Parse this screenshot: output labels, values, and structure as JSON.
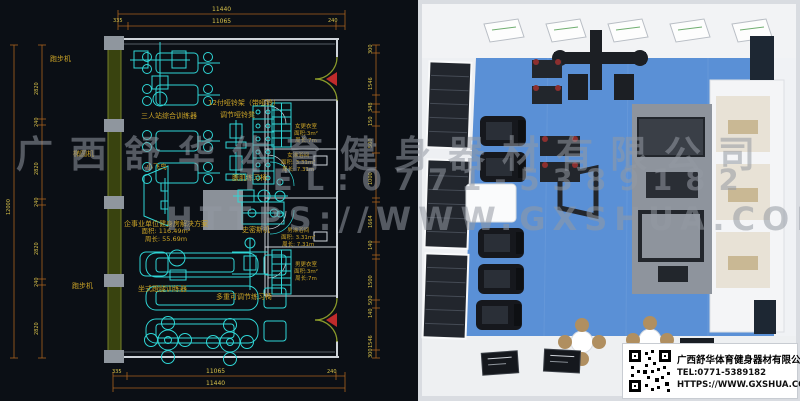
{
  "watermark": {
    "line1": "广西舒华体育健身器材有限公司",
    "line2": "TEL:0771-5389182",
    "line3": "HTTPS://WWW.GXSHUA.COM"
  },
  "info_card": {
    "company": "广西舒华体育健身器材有限公司",
    "tel": "TEL:0771-5389182",
    "website": "HTTPS://WWW.GXSHUA.COM",
    "qr_icon": "qr-code"
  },
  "cad": {
    "equipment_labels": [
      {
        "text": "跑步机"
      },
      {
        "text": "椭圆机"
      },
      {
        "text": "跑步机"
      },
      {
        "text": "三人站综合训练器"
      },
      {
        "text": "12付哑铃架（带哑铃）"
      },
      {
        "text": "调节哑铃凳"
      },
      {
        "text": "小飞鸟"
      },
      {
        "text": "坐式蹬腿训练器"
      },
      {
        "text": "腹肌练习椅"
      },
      {
        "text": "史密斯机"
      },
      {
        "text": "多重可调节练习椅"
      }
    ],
    "solution_note": {
      "title": "企事业单位健身房解决方案",
      "area": "面积: 116.49m²",
      "perimeter": "周长: 55.69m"
    },
    "rooms": [
      {
        "name": "女更衣室",
        "area": "面积:3m²",
        "perimeter": "周长:7m"
      },
      {
        "name": "女淋浴间",
        "area": "面积: 3.31m²",
        "perimeter": "周长: 7.31m"
      },
      {
        "name": "男淋浴间",
        "area": "面积: 3.31m²",
        "perimeter": "周长: 7.31m"
      },
      {
        "name": "男更衣室",
        "area": "面积:3m²",
        "perimeter": "周长:7m"
      }
    ],
    "dimensions": {
      "top_total": "11440",
      "top_inner": "11065",
      "top_left_offset": "335",
      "top_right_offset": "240",
      "bottom_total": "11440",
      "bottom_inner": "11065",
      "bottom_left_offset": "335",
      "bottom_right_offset": "240",
      "left_total": "12000",
      "left_segments": [
        "2820",
        "240",
        "2820",
        "240",
        "2820",
        "240",
        "2820"
      ],
      "right_segments": [
        "300",
        "1546",
        "348",
        "150",
        "500",
        "1000",
        "1664",
        "140",
        "1500",
        "500",
        "140",
        "1546",
        "300"
      ]
    }
  },
  "colors": {
    "cad_background": "#0b0f15",
    "equipment_cyan": "#2fd6d6",
    "label_yellow": "#c9a227",
    "dimension_orange": "#a9611f",
    "dimension_text": "#d9c24a",
    "wall_olive": "#76822b",
    "floor_blue": "#5a90d6",
    "door_red": "#bf2b2b",
    "render_wall_white": "#f2f3f5"
  }
}
